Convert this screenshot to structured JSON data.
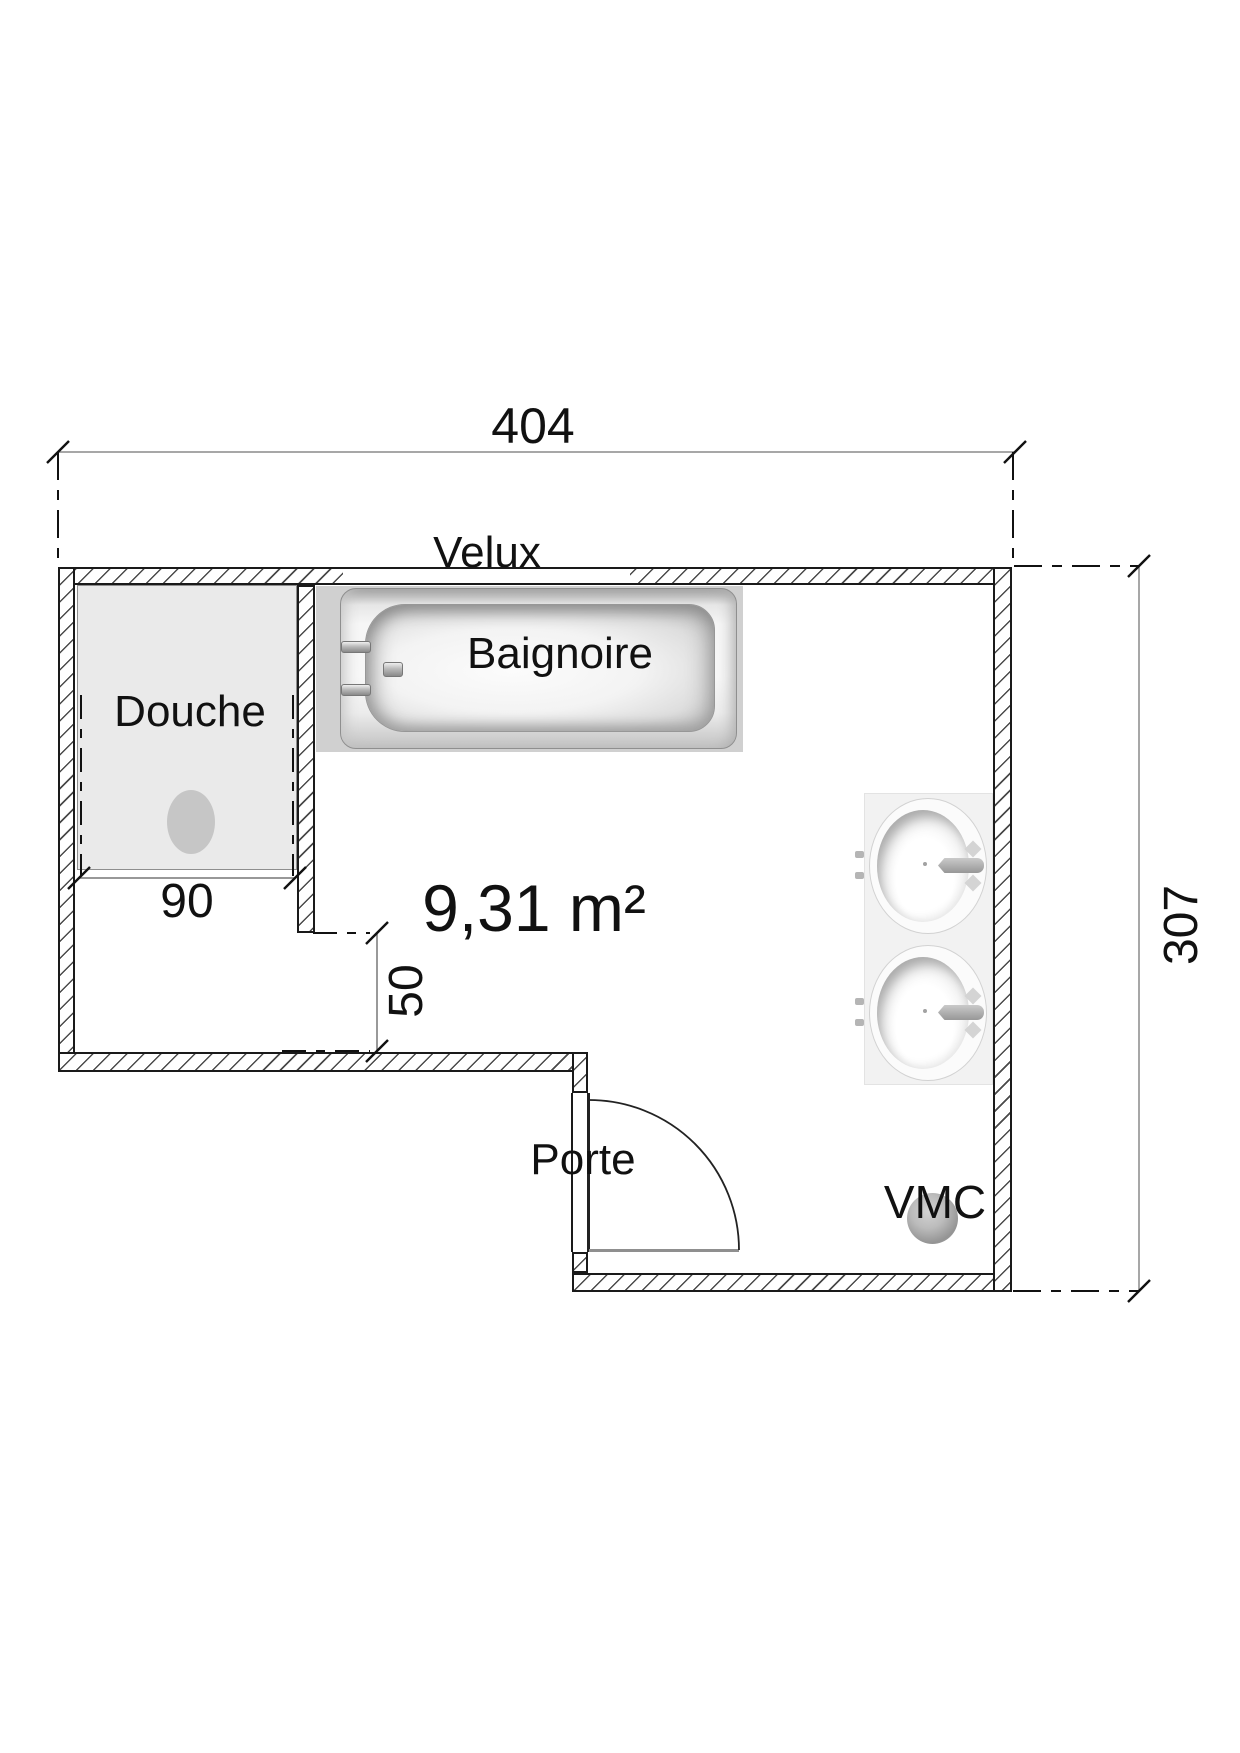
{
  "floorplan": {
    "type": "bathroom-floor-plan",
    "area": "9,31 m²",
    "labels": {
      "shower": "Douche",
      "bathtub": "Baignoire",
      "skylight": "Velux",
      "door": "Porte",
      "vent": "VMC"
    },
    "dimensions": {
      "total_width_cm": "404",
      "total_height_cm": "307",
      "shower_width_cm": "90",
      "passage_cm": "50"
    },
    "colors": {
      "background": "#ffffff",
      "wall_outline": "#1a1a1a",
      "wall_hatch": "#4a4a4a",
      "dim_line_gray": "#8a8a8a",
      "dim_line_dark": "#777777",
      "tick": "#111111",
      "shower_floor": "#eaeaea",
      "drain": "#c6c6c6",
      "tub_background": "#d0d0d0",
      "counter": "#f2f2f2",
      "door_open_leaf": "#8f8f8f",
      "text": "#111111"
    }
  }
}
